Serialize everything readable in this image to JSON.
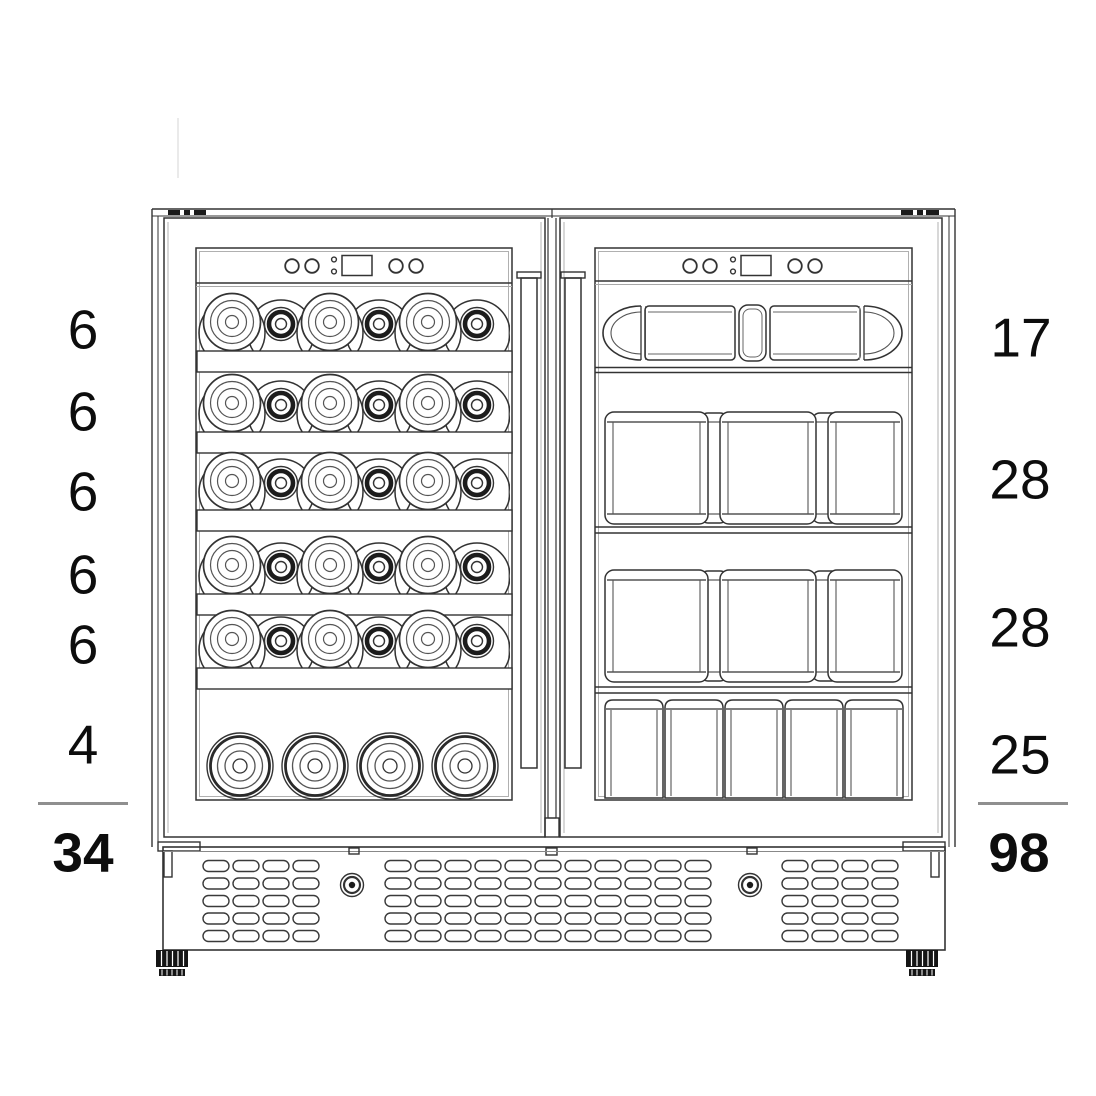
{
  "diagram": {
    "subject": "Dual-zone wine and beverage cooler front view with shelf capacities",
    "colors": {
      "line": "#333333",
      "line_light": "#8a8a8a",
      "text": "#0d0d0d",
      "sum_rule": "#8f8f8f",
      "background": "#ffffff",
      "foot_fill": "#141414"
    },
    "left_door": {
      "zone": "wine-bottle-shelves",
      "row_capacities": [
        "6",
        "6",
        "6",
        "6",
        "6",
        "4"
      ],
      "total": "34"
    },
    "right_door": {
      "zone": "beverage-can-shelves",
      "row_capacities": [
        "17",
        "28",
        "28",
        "25"
      ],
      "total": "98"
    }
  }
}
